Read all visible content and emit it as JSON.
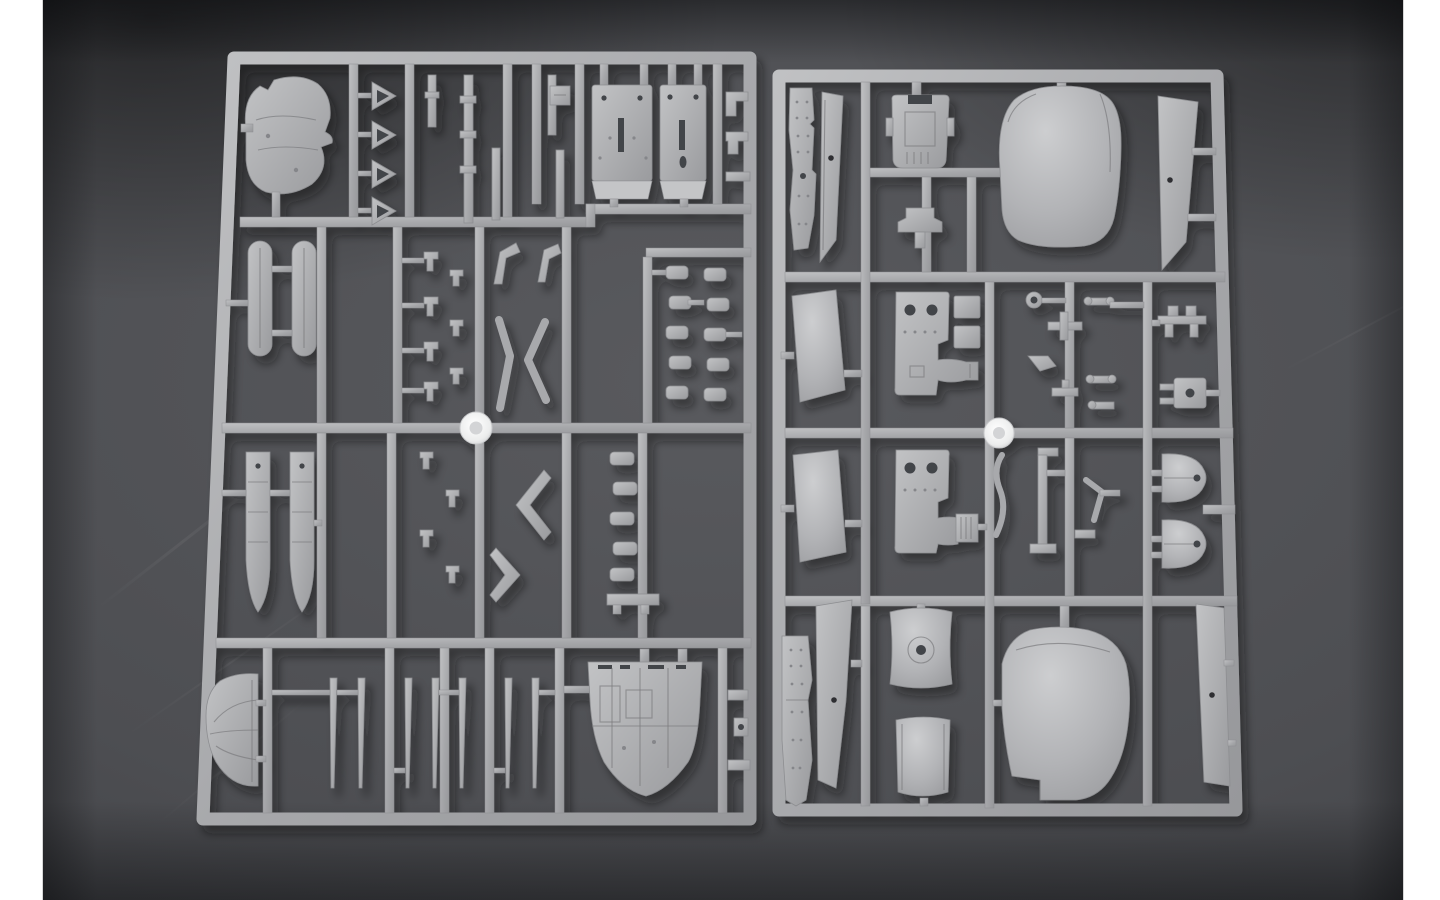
{
  "meta": {
    "type": "photograph",
    "subject": "Overhead photograph of two light-gray injection-molded plastic model kit sprues (parts trees) lying side by side on a dark charcoal backdrop with white margins at the left and right edges",
    "scene": {
      "sprue_count": 2,
      "left_sprue": "dense sprue with engine cowling, hollow triangle funnels, two fuselage deck plates with holes, two rounded float tanks, two pontoon hull halves, small linkage parts, chevron struts, ladder-like part chains, parachute-style half dome, thin blade rods and a boat-shaped hull section with interior framing",
      "right_sprue": "sprue with riveted fuselage side strips, trapezoid wing skin panels with dark ejector-pin marks, cockpit deck, control yoke, large smooth nose cowl, instrument panels with round holes, small fittings, ring and box fittings, two bullet-shaped cowl spinners, saddle panel with domed ring, curved sheet panel and a large curved cowl section",
      "markers": "one shiny white circular tag on a runner near the center of each sprue"
    }
  },
  "palette": {
    "page_margin": "#ffffff",
    "border": "#d6d6d6",
    "backdrop": "#4d4e52",
    "backdrop_light": "#595a5e",
    "backdrop_deep": "#3c3d41",
    "backdrop_dark": "#2c2d30",
    "plastic": "#a8a9ac",
    "plastic_hi": "#c4c5c7",
    "plastic_dark": "#8d8e91",
    "detail": "#7a7b7e",
    "rivet": "#85868a",
    "hole": "#43444a",
    "ejector": "#2e2f32",
    "marker": "#f3f4f6",
    "shadow": "#0c0d0f"
  }
}
